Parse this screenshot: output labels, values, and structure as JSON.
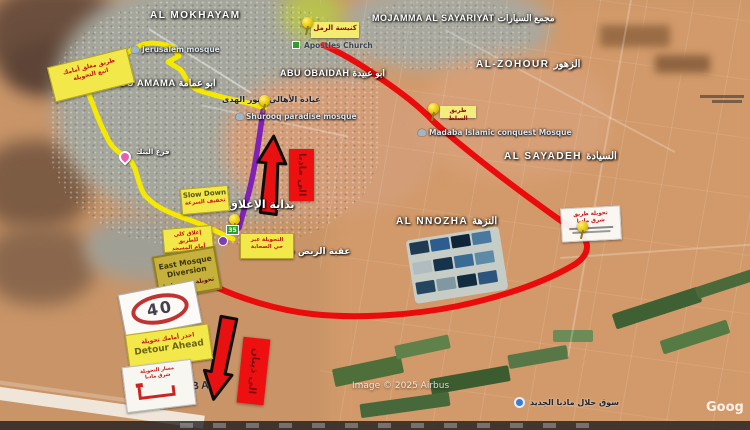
{
  "colors": {
    "route_yellow": "#f6e900",
    "route_red": "#ea0c0c",
    "route_purple": "#8021b8",
    "sign_yellow": "#f2e84a",
    "arrow_red": "#e81010"
  },
  "place_labels": {
    "mokhayam": "AL MOKHAYAM",
    "mojamma": "MOJAMMA AL SAYARIYAT مجمع السيارات",
    "abu_obaidah": "ABU OBAIDAH ابو عبيدة",
    "abu_amama": "ABU AMAMA ابو عمامة",
    "zohour": "AL-ZOHOUR الزهور",
    "sayadeh": "AL SAYADEH السيادة",
    "nnozha": "AL NNOZHA النزهة",
    "madaba": "MADABA"
  },
  "poi_labels": {
    "jerusalem_mosque": "Jerusalem mosque",
    "shurooq_mosque": "Shurooq paradise mosque",
    "conquest_mosque": "Madaba Islamic conquest Mosque",
    "apostles_church": "Apostles Church",
    "market": "سوق حلال مادبا الجديد",
    "salt_road": "طريق السلط"
  },
  "annotations": {
    "clinic": "عيادة الأهالي / نور الهدى",
    "closure_start": "بداية الإغلاق",
    "sahaba": "عقبة الربض حي الصحابة",
    "bank": "فرع البنك",
    "to_madaba": "الى مادبا",
    "to_dhiban": "الى ذيبان",
    "marker_35": "35"
  },
  "signs": {
    "closure": {
      "line1": "طريق مغلق أمامك",
      "line2": "اتبع التحويلة"
    },
    "church": {
      "label": "كنيسة الرمل"
    },
    "slow_down": {
      "en": "Slow Down",
      "ar": "تخفيف السرعة"
    },
    "full_closure": {
      "line1": "إغلاق كلي للطريق",
      "line2": "أمام المسجد"
    },
    "east_diversion": {
      "en": "East Mosque Diversion",
      "ar": "تحويلة شرق مادبا"
    },
    "via_sahaba": {
      "line1": "التحويلة عبر",
      "line2": "حي الصحابة"
    },
    "speed": {
      "value": "40"
    },
    "detour": {
      "ar": "احذر أمامك تحويلة",
      "en": "Detour Ahead"
    },
    "diagram": {
      "line1": "مسار التحويلة",
      "line2": "شرق مادبا"
    },
    "notice": {
      "line1": "تحويلة طريق",
      "line2": "شرق مادبا"
    }
  },
  "attribution": {
    "imagery": "Image © 2025 Airbus",
    "watermark": "Goog"
  }
}
